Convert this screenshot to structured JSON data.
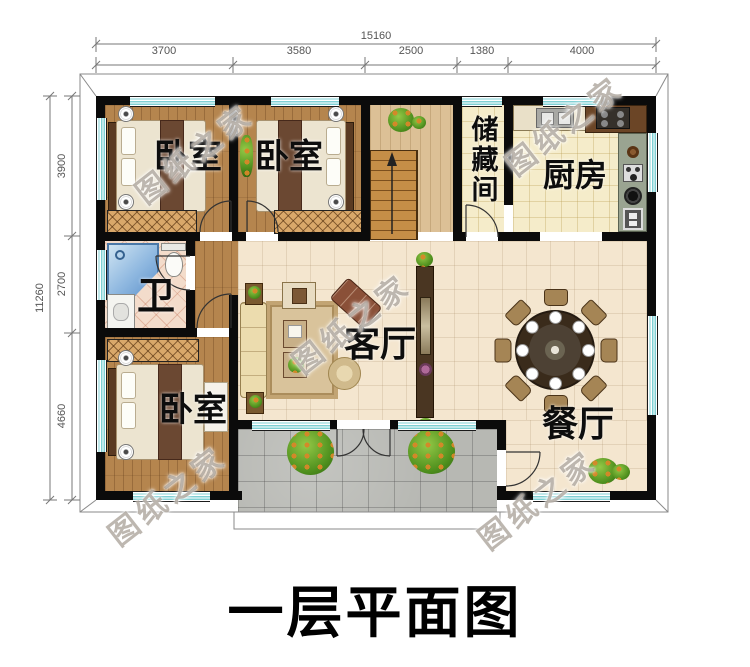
{
  "title": "一层平面图",
  "watermark": "图纸之家",
  "dims": {
    "top_total": "15160",
    "top_segs": [
      "3700",
      "3580",
      "2500",
      "1380",
      "4000"
    ],
    "left_total": "11260",
    "left_segs": [
      "3900",
      "2700",
      "4660"
    ]
  },
  "rooms": {
    "bedroom_top_left": "卧室",
    "bedroom_top_mid": "卧室",
    "bedroom_bottom": "卧室",
    "storage": "储藏间",
    "kitchen": "厨房",
    "bath": "卫",
    "living": "客厅",
    "dining": "餐厅"
  },
  "colors": {
    "wall": "#0b0b0b",
    "window_glass": "#7fd0d4",
    "bedroom_wood_floor": "#b5854e",
    "hall_wood_floor": "#dcc096",
    "living_tile_floor": "#f4e6cf",
    "kitchen_tile_floor": "#f5ecca",
    "bath_tile_floor": "#f3dccb",
    "porch_tile_floor": "#b7b8b3",
    "stairs_wood": "#c58e47",
    "dining_table": "#3a2b1b",
    "plant_green": "#4e8f1d"
  }
}
